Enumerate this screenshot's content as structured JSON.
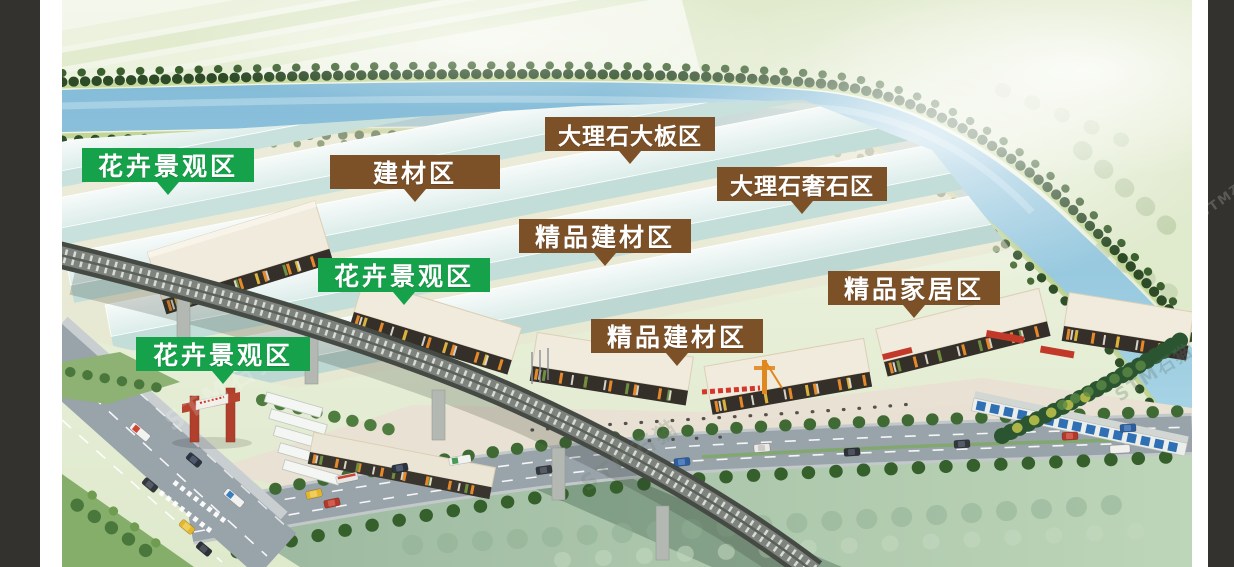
{
  "zones": {
    "labels": [
      {
        "id": "flower-zone-1",
        "text": "花卉景观区",
        "type": "green"
      },
      {
        "id": "building-materials-zone",
        "text": "建材区",
        "type": "brown"
      },
      {
        "id": "marble-slab-zone",
        "text": "大理石大板区",
        "type": "brown"
      },
      {
        "id": "marble-luxury-stone-zone",
        "text": "大理石奢石区",
        "type": "brown"
      },
      {
        "id": "premium-building-materials-zone-1",
        "text": "精品建材区",
        "type": "brown"
      },
      {
        "id": "flower-zone-2",
        "text": "花卉景观区",
        "type": "green"
      },
      {
        "id": "premium-building-materials-zone-2",
        "text": "精品建材区",
        "type": "brown"
      },
      {
        "id": "premium-home-zone",
        "text": "精品家居区",
        "type": "brown"
      },
      {
        "id": "flower-zone-3",
        "text": "花卉景观区",
        "type": "green"
      }
    ],
    "colors": {
      "green": "#16a24b",
      "brown": "#7d5128",
      "text": "#ffffff"
    }
  },
  "watermark": {
    "text": "STM石猫"
  },
  "scene_colors": {
    "side_bars": "#34322e",
    "river": "#93c6de",
    "field_pale": "#e7efd8",
    "field_green": "#a9c3ab",
    "road": "#99a3aa",
    "roof_cream": "#f0ebdc",
    "facade_dark": "#352f2a",
    "warehouse_roof": "#eef7f4",
    "warehouse_wall": "#c7e0db",
    "trees_dark": "#2e4d26",
    "viaduct": "#454a44",
    "lawn": "#85ae6a",
    "gate_red": "#b0402c"
  }
}
